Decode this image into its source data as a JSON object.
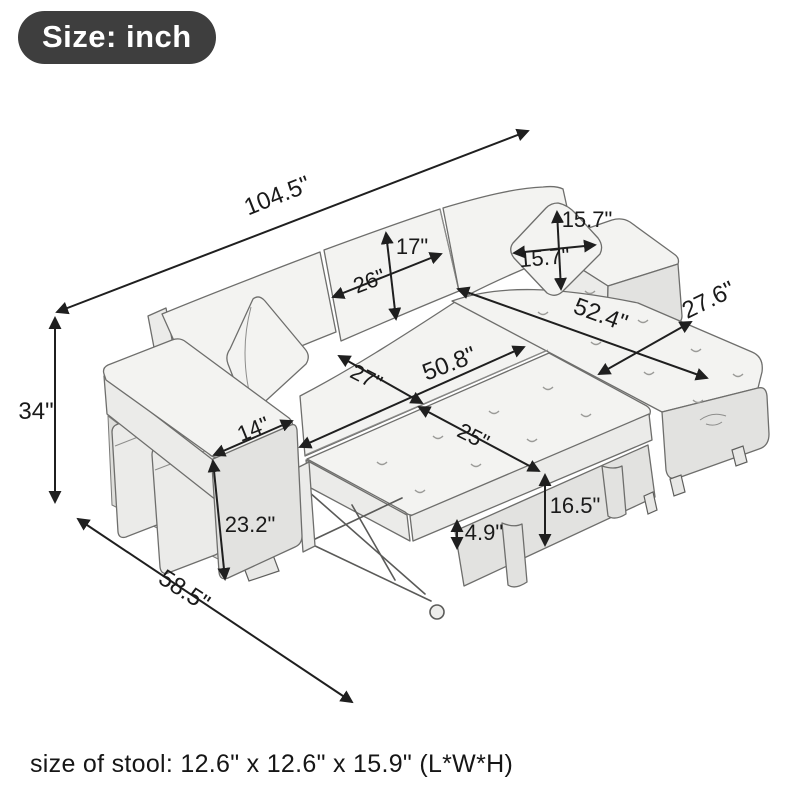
{
  "badge": {
    "label": "Size: inch"
  },
  "caption": {
    "text": "size of stool: 12.6\" x 12.6\" x 15.9\" (L*W*H)"
  },
  "colors": {
    "badge_background": "#3e3e3e",
    "badge_text": "#ffffff",
    "line_art_stroke": "#6e6e6c",
    "dimension_line": "#1f1f1f",
    "fabric_fill": "#f3f3f1"
  },
  "dimensions": {
    "overall_width": "104.5\"",
    "overall_height": "34\"",
    "depth_bed_open": "58.5\"",
    "armrest_width": "14\"",
    "armrest_height": "23.2\"",
    "back_cushion_height": "17\"",
    "back_cushion_width": "26\"",
    "pillow_height": "15.7\"",
    "pillow_width": "15.7\"",
    "chaise_length": "52.4\"",
    "chaise_width": "27.6\"",
    "seat_width": "50.8\"",
    "seat_depth": "27\"",
    "bed_extension_depth": "25\"",
    "bed_height": "16.5\"",
    "mattress_thickness": "4.9\""
  }
}
